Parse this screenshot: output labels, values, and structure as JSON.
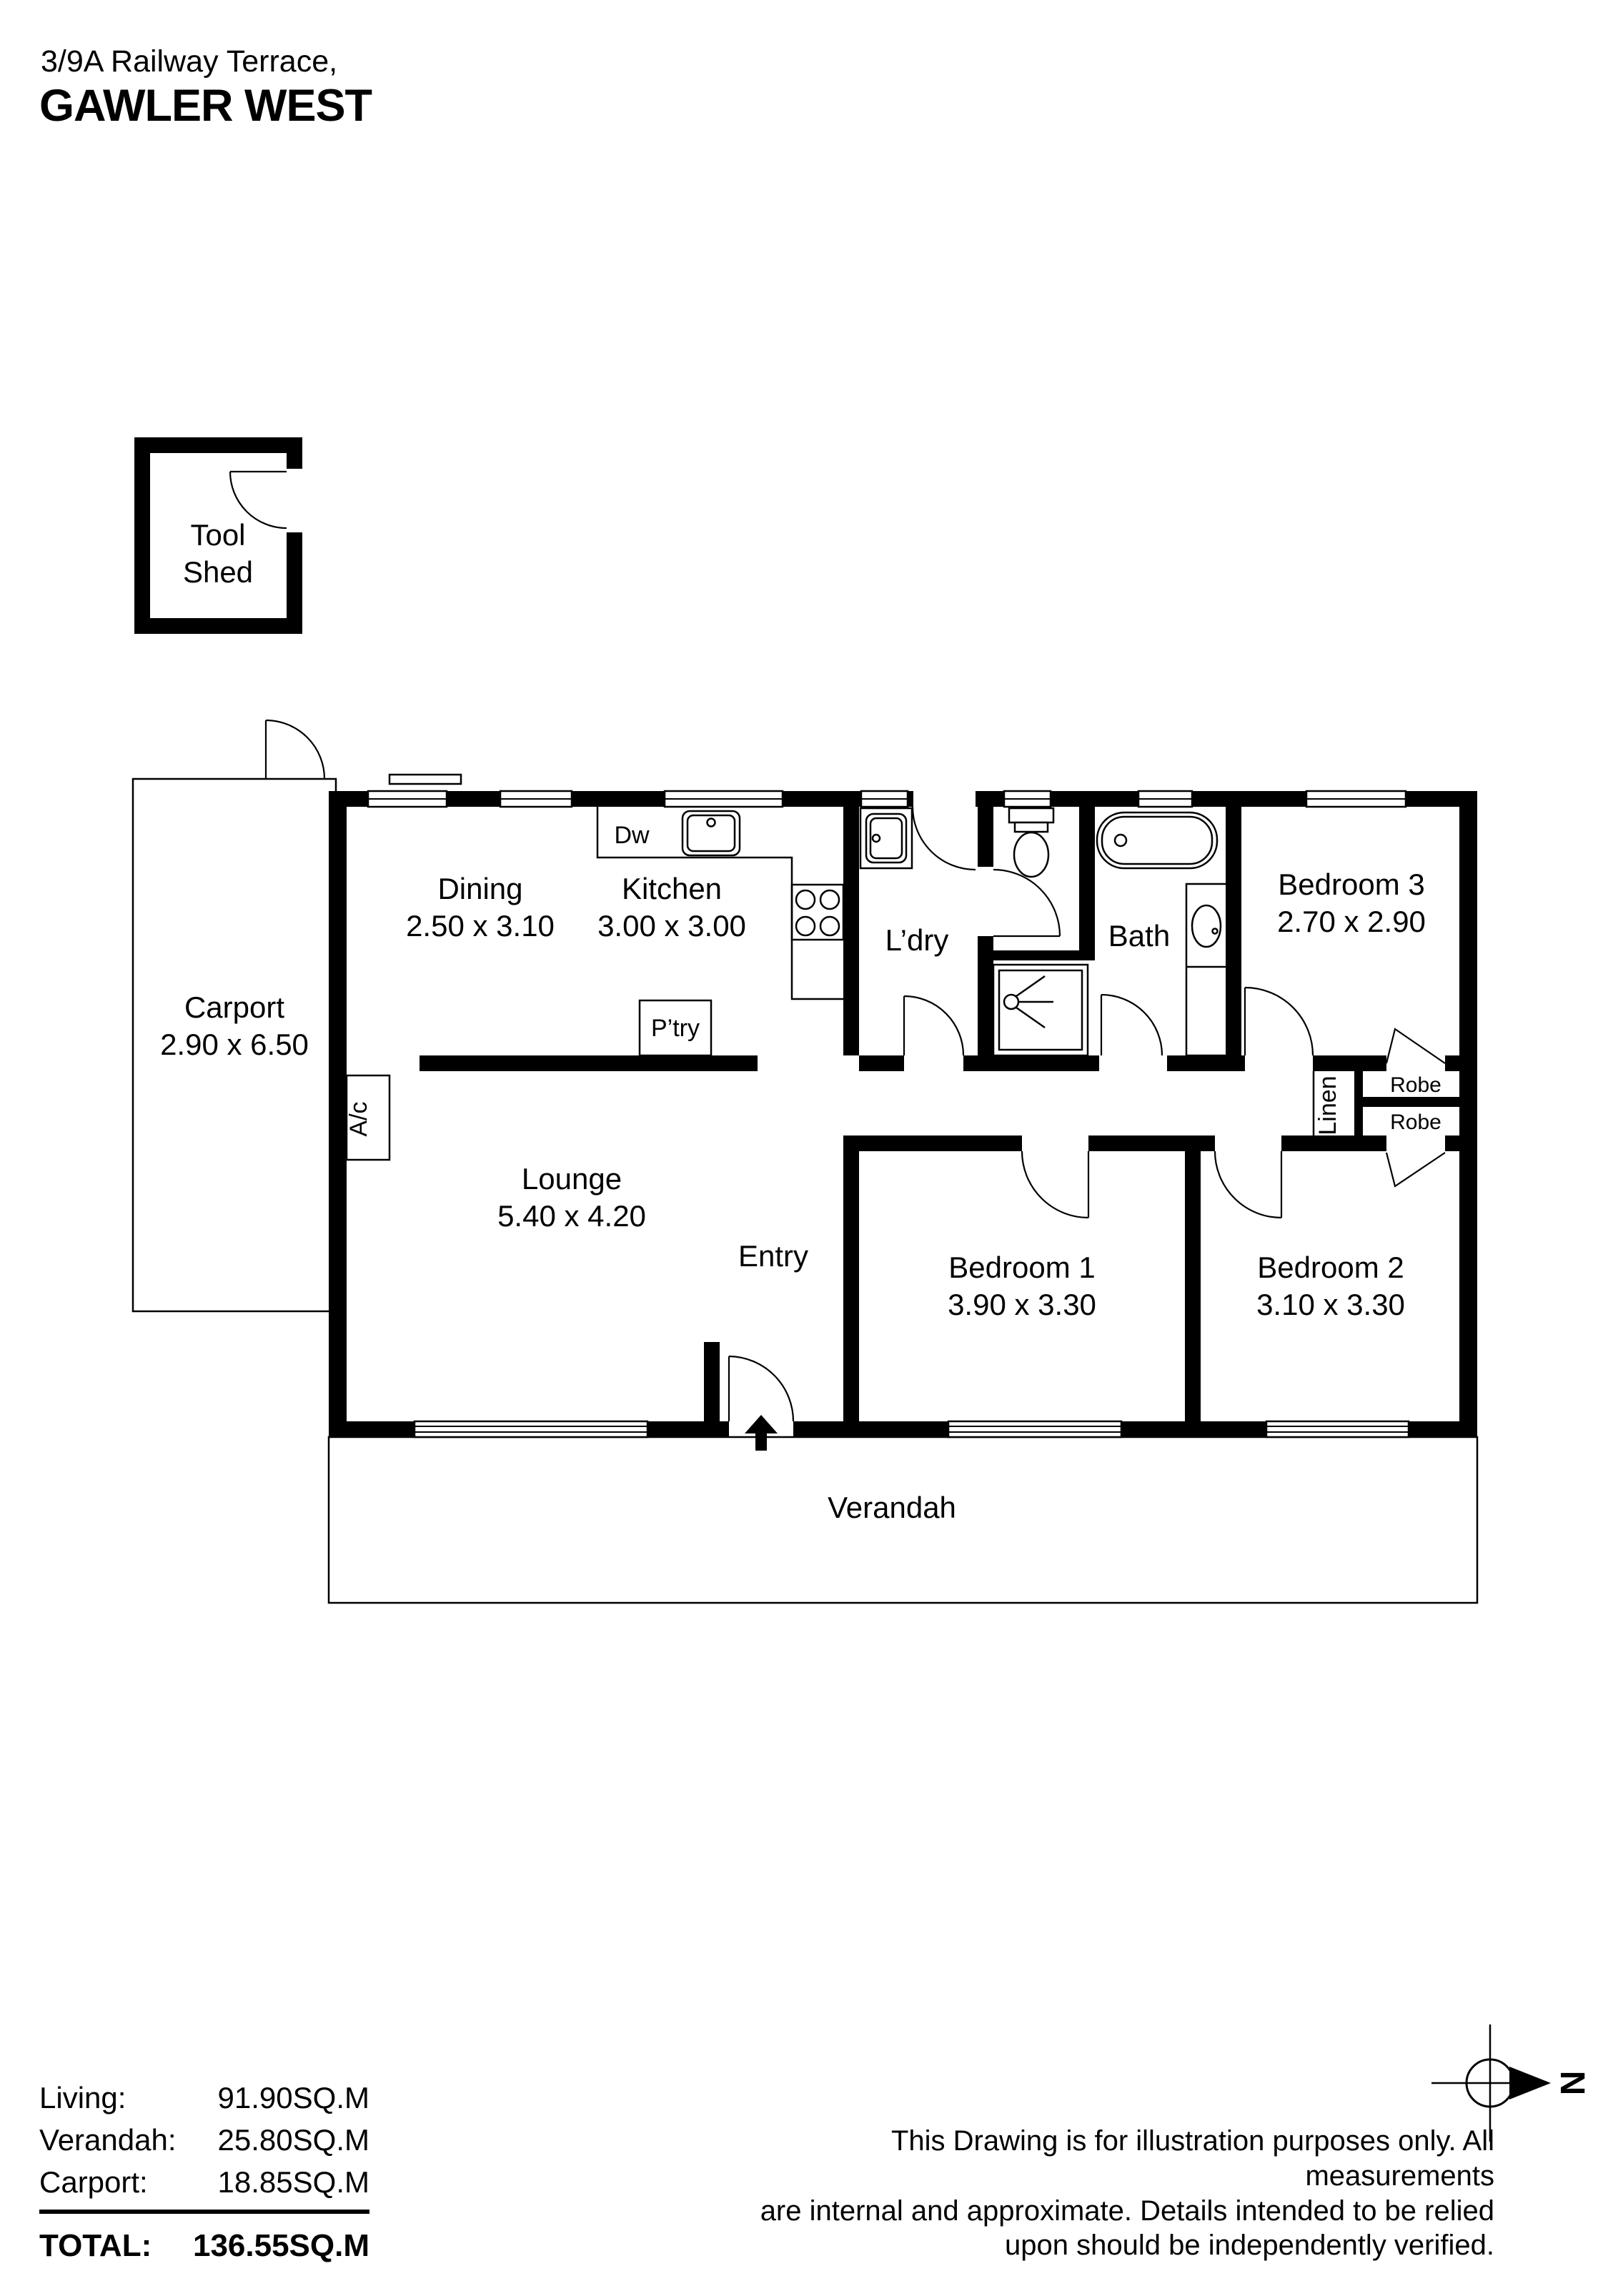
{
  "header": {
    "address_line1": "3/9A Railway Terrace,",
    "address_line2": "GAWLER WEST"
  },
  "plan": {
    "tool_shed": {
      "line1": "Tool",
      "line2": "Shed"
    },
    "carport": {
      "name": "Carport",
      "dims": "2.90 x 6.50"
    },
    "dining": {
      "name": "Dining",
      "dims": "2.50 x 3.10"
    },
    "kitchen": {
      "name": "Kitchen",
      "dims": "3.00 x 3.00"
    },
    "laundry": {
      "name": "L’dry"
    },
    "bath": {
      "name": "Bath"
    },
    "bedroom3": {
      "name": "Bedroom 3",
      "dims": "2.70 x 2.90"
    },
    "lounge": {
      "name": "Lounge",
      "dims": "5.40 x 4.20"
    },
    "entry": {
      "name": "Entry"
    },
    "bedroom1": {
      "name": "Bedroom 1",
      "dims": "3.90 x 3.30"
    },
    "bedroom2": {
      "name": "Bedroom 2",
      "dims": "3.10 x 3.30"
    },
    "verandah": {
      "name": "Verandah"
    },
    "fixtures": {
      "dishwasher": "Dw",
      "pantry": "P’try",
      "aircon": "A/c",
      "linen": "Linen",
      "robe_top": "Robe",
      "robe_bottom": "Robe"
    }
  },
  "compass": {
    "north": "N"
  },
  "areas": {
    "rows": [
      {
        "label": "Living:",
        "value": "91.90SQ.M"
      },
      {
        "label": "Verandah:",
        "value": "25.80SQ.M"
      },
      {
        "label": "Carport:",
        "value": "18.85SQ.M"
      }
    ],
    "total_label": "TOTAL:",
    "total_value": "136.55SQ.M"
  },
  "disclaimer": [
    "This Drawing is for illustration purposes only. All measurements",
    "are internal and approximate. Details intended to be relied",
    "upon should be independently verified."
  ]
}
